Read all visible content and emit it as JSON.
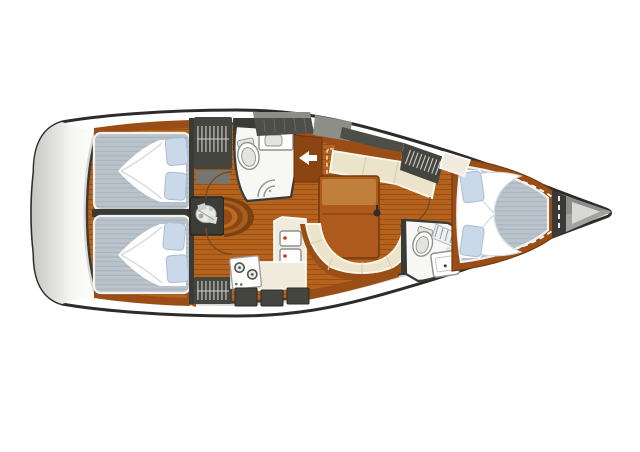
{
  "diagram": {
    "type": "sailboat-interior-layout-plan",
    "orientation": "bow-right-stern-left",
    "regions": [
      "aft-cabin-port",
      "aft-cabin-starboard",
      "aft-head",
      "companionway",
      "engine-compartment",
      "galley",
      "salon-dinette",
      "forward-head",
      "forward-cabin-v-berth",
      "anchor-locker"
    ],
    "icons": [
      "engine-icon",
      "toilet-icon",
      "sink-icon",
      "stove-icon",
      "shower-icon",
      "hanging-locker-icon",
      "entry-arrow-icon",
      "mast-post-icon"
    ]
  },
  "colors": {
    "page_bg": "#ffffff",
    "hull_outline": "#2c2c2a",
    "deck_shade": "#d8d8d5",
    "transom_gray": "#c6c6c4",
    "wall_dark": "#3a3a36",
    "cabinet_dark": "#45453f",
    "cabinet_mid": "#76766f",
    "hatch_gray": "#4e4e48",
    "hatch_gray_light": "#8e8e88",
    "wood_floor": "#b4621d",
    "wood_plank": "#99500f",
    "wood_trim": "#9a4e16",
    "wood_block": "#8a4512",
    "wood_table": "#ad5a1c",
    "wood_table_light": "#c0803c",
    "step_1": "#7a4210",
    "step_2": "#a85c1e",
    "step_3": "#8a4712",
    "step_4": "#bd6b24",
    "step_5": "#934d14",
    "mattress_base": "#bac3cb",
    "mattress_stripe": "#aab4bd",
    "mattress_edge": "#f2f2f0",
    "pillow": "#cad9e9",
    "pillow_line": "#a9bdd3",
    "blanket": "#ffffff",
    "blanket_shadow": "#d5dadd",
    "cushion": "#ebe4ca",
    "cushion_edge": "#f8f5ea",
    "cushion_seam": "#d8d0b2",
    "counter": "#f0ebdd",
    "fixture_white": "#f7f7f5",
    "fixture_inner": "#e3e3e1",
    "fixture_line": "#8f8f8d",
    "bath_floor": "#d6e2e8",
    "shower_glass": "#9a9a98",
    "red_dot": "#c03a2a",
    "door_arc": "#7b4a1e",
    "hatch_dash": "#e8d9c2",
    "hanger_line": "#d0d0cc",
    "anchor_gray": "#a2a2a0",
    "anchor_dark": "#8c8c88",
    "anchor_light": "#d8d8d6",
    "bow_deck": "#aaaaa8"
  }
}
